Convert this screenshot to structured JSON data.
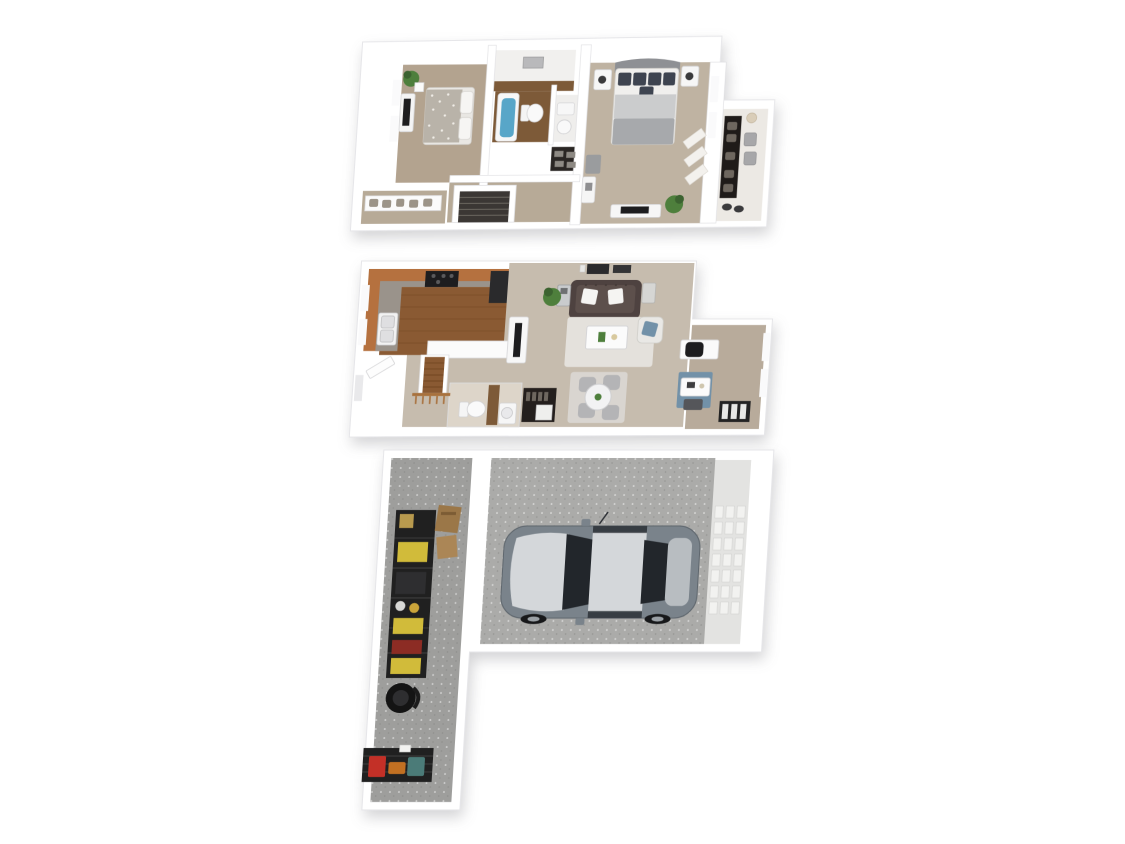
{
  "scene": {
    "type": "3d-rendered-floor-plan",
    "view": "top-down perspective dollhouse",
    "background": "#ffffff",
    "levels": 3
  },
  "floors": [
    {
      "id": "upper",
      "name": "upper-bedroom-level",
      "rooms": [
        "bedroom-left",
        "laundry-utility",
        "bathroom",
        "vanity-nook",
        "linen-closet",
        "stairwell",
        "hall-closet",
        "bedroom-right",
        "walk-in-closet"
      ],
      "furniture": [
        "bed-speckled-blanket",
        "dresser-with-tv",
        "potted-plant",
        "bathtub",
        "toilet",
        "pedestal-sink",
        "stairs-down",
        "shelf-with-clothes",
        "bed-gray-duvet",
        "nightstand-left",
        "nightstand-right",
        "bench-ottoman",
        "vanity-desk",
        "long-dresser",
        "potted-plant",
        "chevron-rugs",
        "wardrobe-dark",
        "closet-stools"
      ]
    },
    {
      "id": "main",
      "name": "main-living-level",
      "rooms": [
        "kitchen",
        "living-room",
        "dining-area",
        "entry",
        "stairs-up",
        "half-bath",
        "coat-closet",
        "den-office"
      ],
      "furniture": [
        "u-shaped-cabinets",
        "range-black",
        "refrigerator",
        "double-sink",
        "peninsula-counter",
        "tv-console",
        "chesterfield-sofa",
        "white-pillows",
        "bar-cart",
        "end-table",
        "potted-plant",
        "shag-rug",
        "coffee-table",
        "armchair-blue-pillow",
        "wall-art",
        "round-dining-table",
        "dining-chairs-x4",
        "dining-rug",
        "desk-with-office-chair",
        "blue-area-rug",
        "writing-desk",
        "bookshelf",
        "toilet",
        "pedestal-sink",
        "stair-railing",
        "entry-door"
      ]
    },
    {
      "id": "garage",
      "name": "garage-basement-level",
      "rooms": [
        "storage-room",
        "single-car-garage",
        "utility-corridor"
      ],
      "furniture": [
        "wire-shelving-rack",
        "tool-boxes-yellow",
        "cardboard-boxes",
        "shop-vacuum",
        "wire-basket-rack",
        "red-toolbox",
        "orange-tool",
        "teal-case",
        "sedan-car",
        "garage-door-panel"
      ]
    }
  ],
  "colors": {
    "wall": "#ffffff",
    "wallShade": "#e4e4e7",
    "outline": "#d9d9dc",
    "windowLight": "#fafafb",
    "carpetUpperLeft": "#b3a38f",
    "carpetUpperRight": "#bfb3a2",
    "hallCarpet": "#b7aa97",
    "closetFloor": "#ece9e4",
    "blanketSpeckle": "#b9b3a9",
    "headboardGray": "#8e9094",
    "pillowNavy": "#3e4450",
    "duvetLight": "#cbcccd",
    "duvetMid": "#a7a9ac",
    "benchGray": "#9a9c9e",
    "stairDark": "#3b3734",
    "woodFloor": "#8a5a33",
    "cabinetWood": "#b5713f",
    "granite": "#9a938b",
    "applianceBlack": "#1d1d1f",
    "tubWater": "#58a6c8",
    "bathFloorWood": "#7d5a38",
    "carpetMain": "#c6bcae",
    "carpetDen": "#b8ab9b",
    "sofaBrown": "#4e4240",
    "pillowWhite": "#f5f4f2",
    "rugShag": "#e4e1dc",
    "rugDining": "#d9d5d0",
    "rugBlue": "#7291a8",
    "tableWhite": "#f7f7f8",
    "chairGray": "#b4b4b6",
    "woodRail": "#a8713d",
    "concreteLight": "#ababa9",
    "concreteDark": "#9e9e9c",
    "rackBlack": "#202020",
    "toolYellow": "#d1bb3a",
    "boxBrown": "#9b7748",
    "itemRed": "#c33027",
    "itemOrange": "#c17022",
    "itemTeal": "#4b7b78",
    "doorPanel": "#e3e3e1",
    "carBody": "#7a838b",
    "carSilver": "#d4d7da",
    "carGlass": "#22262b",
    "carTrunk": "#b8bdc1",
    "wheelDark": "#17181a",
    "plantGreen": "#4e7f3c",
    "plantDark": "#3c6330",
    "lampDark": "#3a3a3c"
  }
}
